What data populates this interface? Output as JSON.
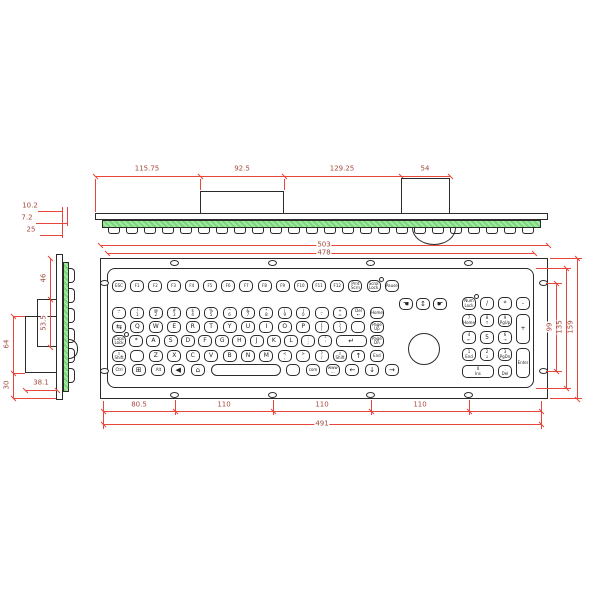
{
  "colors": {
    "dimension_line": "#e8463a",
    "dimension_text": "#a34a3e",
    "pcb_green": "#7bd67b",
    "outline": "#2b2b2b"
  },
  "top_view": {
    "dims": [
      "115.75",
      "92.5",
      "129.25",
      "54"
    ],
    "thickness": [
      "10.2",
      "7.2",
      "25"
    ]
  },
  "side_view": {
    "dims": [
      "46",
      "53.5",
      "64",
      "30",
      "38.1"
    ]
  },
  "front_view": {
    "dims": {
      "outer_width": "503",
      "inner_width": "478",
      "hole_span": "99",
      "inner_height": "135",
      "outer_height": "159",
      "bottom": [
        "80.5",
        "110",
        "110",
        "110"
      ],
      "bottom_total": "491"
    },
    "rows": [
      [
        {
          "l": "ESC",
          "n": "esc-key"
        },
        {
          "l": "F1"
        },
        {
          "l": "F2"
        },
        {
          "l": "F3"
        },
        {
          "l": "F4"
        },
        {
          "l": "F5"
        },
        {
          "l": "F6"
        },
        {
          "l": "F7"
        },
        {
          "l": "F8"
        },
        {
          "l": "F9"
        },
        {
          "l": "F10"
        },
        {
          "l": "F11"
        },
        {
          "l": "F12"
        },
        {
          "t": "Prnt",
          "b": "Scrn",
          "n": "printscreen-key"
        },
        {
          "t": "Scrol",
          "b": "Lock",
          "led": 1,
          "n": "scrolllock-key"
        },
        {
          "l": "Pause",
          "n": "pause-key"
        }
      ],
      [
        {
          "t": "~",
          "b": "`",
          "n": "backtick-key"
        },
        {
          "t": "!",
          "b": "1"
        },
        {
          "t": "@",
          "b": "2"
        },
        {
          "t": "#",
          "b": "3"
        },
        {
          "t": "$",
          "b": "4"
        },
        {
          "t": "%",
          "b": "5"
        },
        {
          "t": "^",
          "b": "6"
        },
        {
          "t": "&",
          "b": "7"
        },
        {
          "t": "*",
          "b": "8"
        },
        {
          "t": "(",
          "b": "9"
        },
        {
          "t": ")",
          "b": "0"
        },
        {
          "t": "_",
          "b": "-",
          "n": "minus-key"
        },
        {
          "t": "+",
          "b": "=",
          "n": "equals-key"
        },
        {
          "t": "Del",
          "b": "←",
          "n": "backspace-key"
        },
        {
          "l": "Home",
          "n": "home-key"
        }
      ],
      [
        {
          "g": "⇆",
          "n": "tab-key"
        },
        {
          "l": "Q"
        },
        {
          "l": "W"
        },
        {
          "l": "E"
        },
        {
          "l": "R"
        },
        {
          "l": "T"
        },
        {
          "l": "Y"
        },
        {
          "l": "U"
        },
        {
          "l": "I"
        },
        {
          "l": "O"
        },
        {
          "l": "P"
        },
        {
          "t": "{",
          "b": "[",
          "n": "lbracket-key"
        },
        {
          "t": "}",
          "b": "]",
          "n": "rbracket-key"
        },
        {
          "blank": 1,
          "n": "blank-key"
        },
        {
          "t": "Page",
          "b": "Up",
          "n": "pageup-key"
        }
      ],
      [
        {
          "t": "Caps",
          "b": "Lock",
          "led": 1,
          "n": "capslock-key"
        },
        {
          "l": "*",
          "n": "star-key"
        },
        {
          "l": "A"
        },
        {
          "l": "S"
        },
        {
          "l": "D"
        },
        {
          "l": "F"
        },
        {
          "l": "G"
        },
        {
          "l": "H"
        },
        {
          "l": "J"
        },
        {
          "l": "K"
        },
        {
          "l": "L"
        },
        {
          "t": ":",
          "b": ";",
          "n": "semicolon-key"
        },
        {
          "t": "\"",
          "b": "'",
          "n": "quote-key"
        },
        {
          "g": "↵",
          "w2": 1,
          "n": "enter-key"
        },
        {
          "t": "Page",
          "b": "Dn",
          "n": "pagedown-key"
        }
      ],
      [
        {
          "t": "⇧",
          "b": "Shift",
          "n": "left-shift-key"
        },
        {
          "blank": 1,
          "n": "blank-key"
        },
        {
          "l": "Z"
        },
        {
          "l": "X"
        },
        {
          "l": "C"
        },
        {
          "l": "V"
        },
        {
          "l": "B"
        },
        {
          "l": "N"
        },
        {
          "l": "M"
        },
        {
          "t": "<",
          "b": ",",
          "n": "comma-key"
        },
        {
          "t": ">",
          "b": ".",
          "n": "period-key"
        },
        {
          "t": "?",
          "b": "/",
          "n": "slash-key"
        },
        {
          "t": "⇧",
          "b": "Shift",
          "n": "right-shift-key"
        },
        {
          "g": "↑",
          "n": "up-arrow-key"
        },
        {
          "l": "End",
          "n": "end-key"
        }
      ],
      [
        {
          "l": "Ctrl",
          "n": "ctrl-key"
        },
        {
          "g": "⊞",
          "n": "win-key"
        },
        {
          "l": "Alt",
          "n": "alt-key"
        },
        {
          "g": "◀",
          "n": "browser-back-key"
        },
        {
          "g": "⌂",
          "n": "web-home-key"
        },
        {
          "blank": 1,
          "sp": 1,
          "n": "space-key"
        },
        {
          "blank": 1,
          "n": "blank-key"
        },
        {
          "l": "com",
          "n": "com-key"
        },
        {
          "t": "www",
          "b": "...",
          "n": "www-key"
        },
        {
          "g": "←",
          "n": "left-arrow-key"
        },
        {
          "g": "↓",
          "n": "down-arrow-key"
        },
        {
          "g": "→",
          "n": "right-arrow-key"
        }
      ]
    ],
    "mouse_keys": [
      {
        "g": "☚",
        "n": "mouse-left-click-key"
      },
      {
        "g": "↕",
        "n": "mouse-scroll-key"
      },
      {
        "g": "☛",
        "n": "mouse-right-click-key"
      }
    ],
    "numpad": [
      {
        "t": "Num",
        "b": "Lock",
        "led": 1,
        "n": "numlock-key"
      },
      {
        "l": "/",
        "n": "numpad-divide-key"
      },
      {
        "l": "*",
        "n": "numpad-multiply-key"
      },
      {
        "l": "-",
        "n": "numpad-minus-key"
      },
      {
        "t": "7",
        "b": "Home",
        "n": "numpad-7-key"
      },
      {
        "t": "8",
        "b": "↑",
        "n": "numpad-8-key"
      },
      {
        "t": "9",
        "b": "PgUp",
        "n": "numpad-9-key"
      },
      {
        "l": "+",
        "tall": 1,
        "n": "numpad-plus-key"
      },
      {
        "t": "4",
        "b": "←",
        "n": "numpad-4-key"
      },
      {
        "l": "5",
        "n": "numpad-5-key"
      },
      {
        "t": "6",
        "b": "→",
        "n": "numpad-6-key"
      },
      {
        "t": "1",
        "b": "End",
        "n": "numpad-1-key"
      },
      {
        "t": "2",
        "b": "↓",
        "n": "numpad-2-key"
      },
      {
        "t": "3",
        "b": "PgDn",
        "n": "numpad-3-key"
      },
      {
        "l": "Enter",
        "tall": 1,
        "n": "numpad-enter-key"
      },
      {
        "t": "0",
        "b": "Ins",
        "wide": 1,
        "n": "numpad-0-key"
      },
      {
        "t": ".",
        "b": "Del",
        "n": "numpad-dot-key"
      }
    ]
  }
}
